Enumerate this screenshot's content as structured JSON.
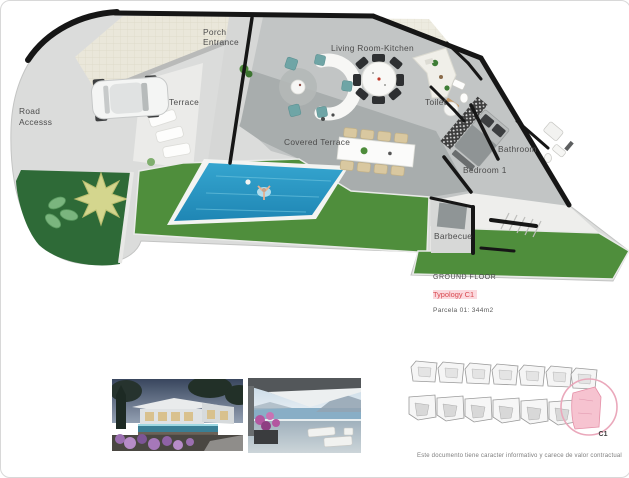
{
  "floor_plan": {
    "labels": {
      "porch_line1": "Porch",
      "porch_line2": "Entrance",
      "living_room_kitchen": "Living Room-Kitchen",
      "road_line1": "Road",
      "road_line2": "Accesss",
      "terrace": "Terrace",
      "covered_terrace": "Covered Terrace",
      "toilet": "Toilet",
      "bathroom": "Bathroom",
      "bedroom_1": "Bedroom 1",
      "barbecue": "Barbecue"
    },
    "colors": {
      "wall": "#161616",
      "sidewalk": "#dbdcdb",
      "paving_beige": "#eae7da",
      "interior_floor": "#c2c5c5",
      "covered_terrace_floor": "#a8adad",
      "lawn": "#4f8e3c",
      "garden": "#2e6a37",
      "pool_water": "#2e9ec8"
    }
  },
  "caption": {
    "title": "GROUND FLOOR",
    "typology": "Typology C1",
    "typology_color": "#d8494f",
    "typology_bg": "#fbd9de",
    "parcel": "Parcela 01: 344m2"
  },
  "site_plan": {
    "unit_label": "C1",
    "highlight_fill": "#f6c3d0",
    "circle_color": "#eaa8bb"
  },
  "footer": {
    "disclaimer": "Este documento tiene caracter informativo y carece de valor contractual"
  }
}
